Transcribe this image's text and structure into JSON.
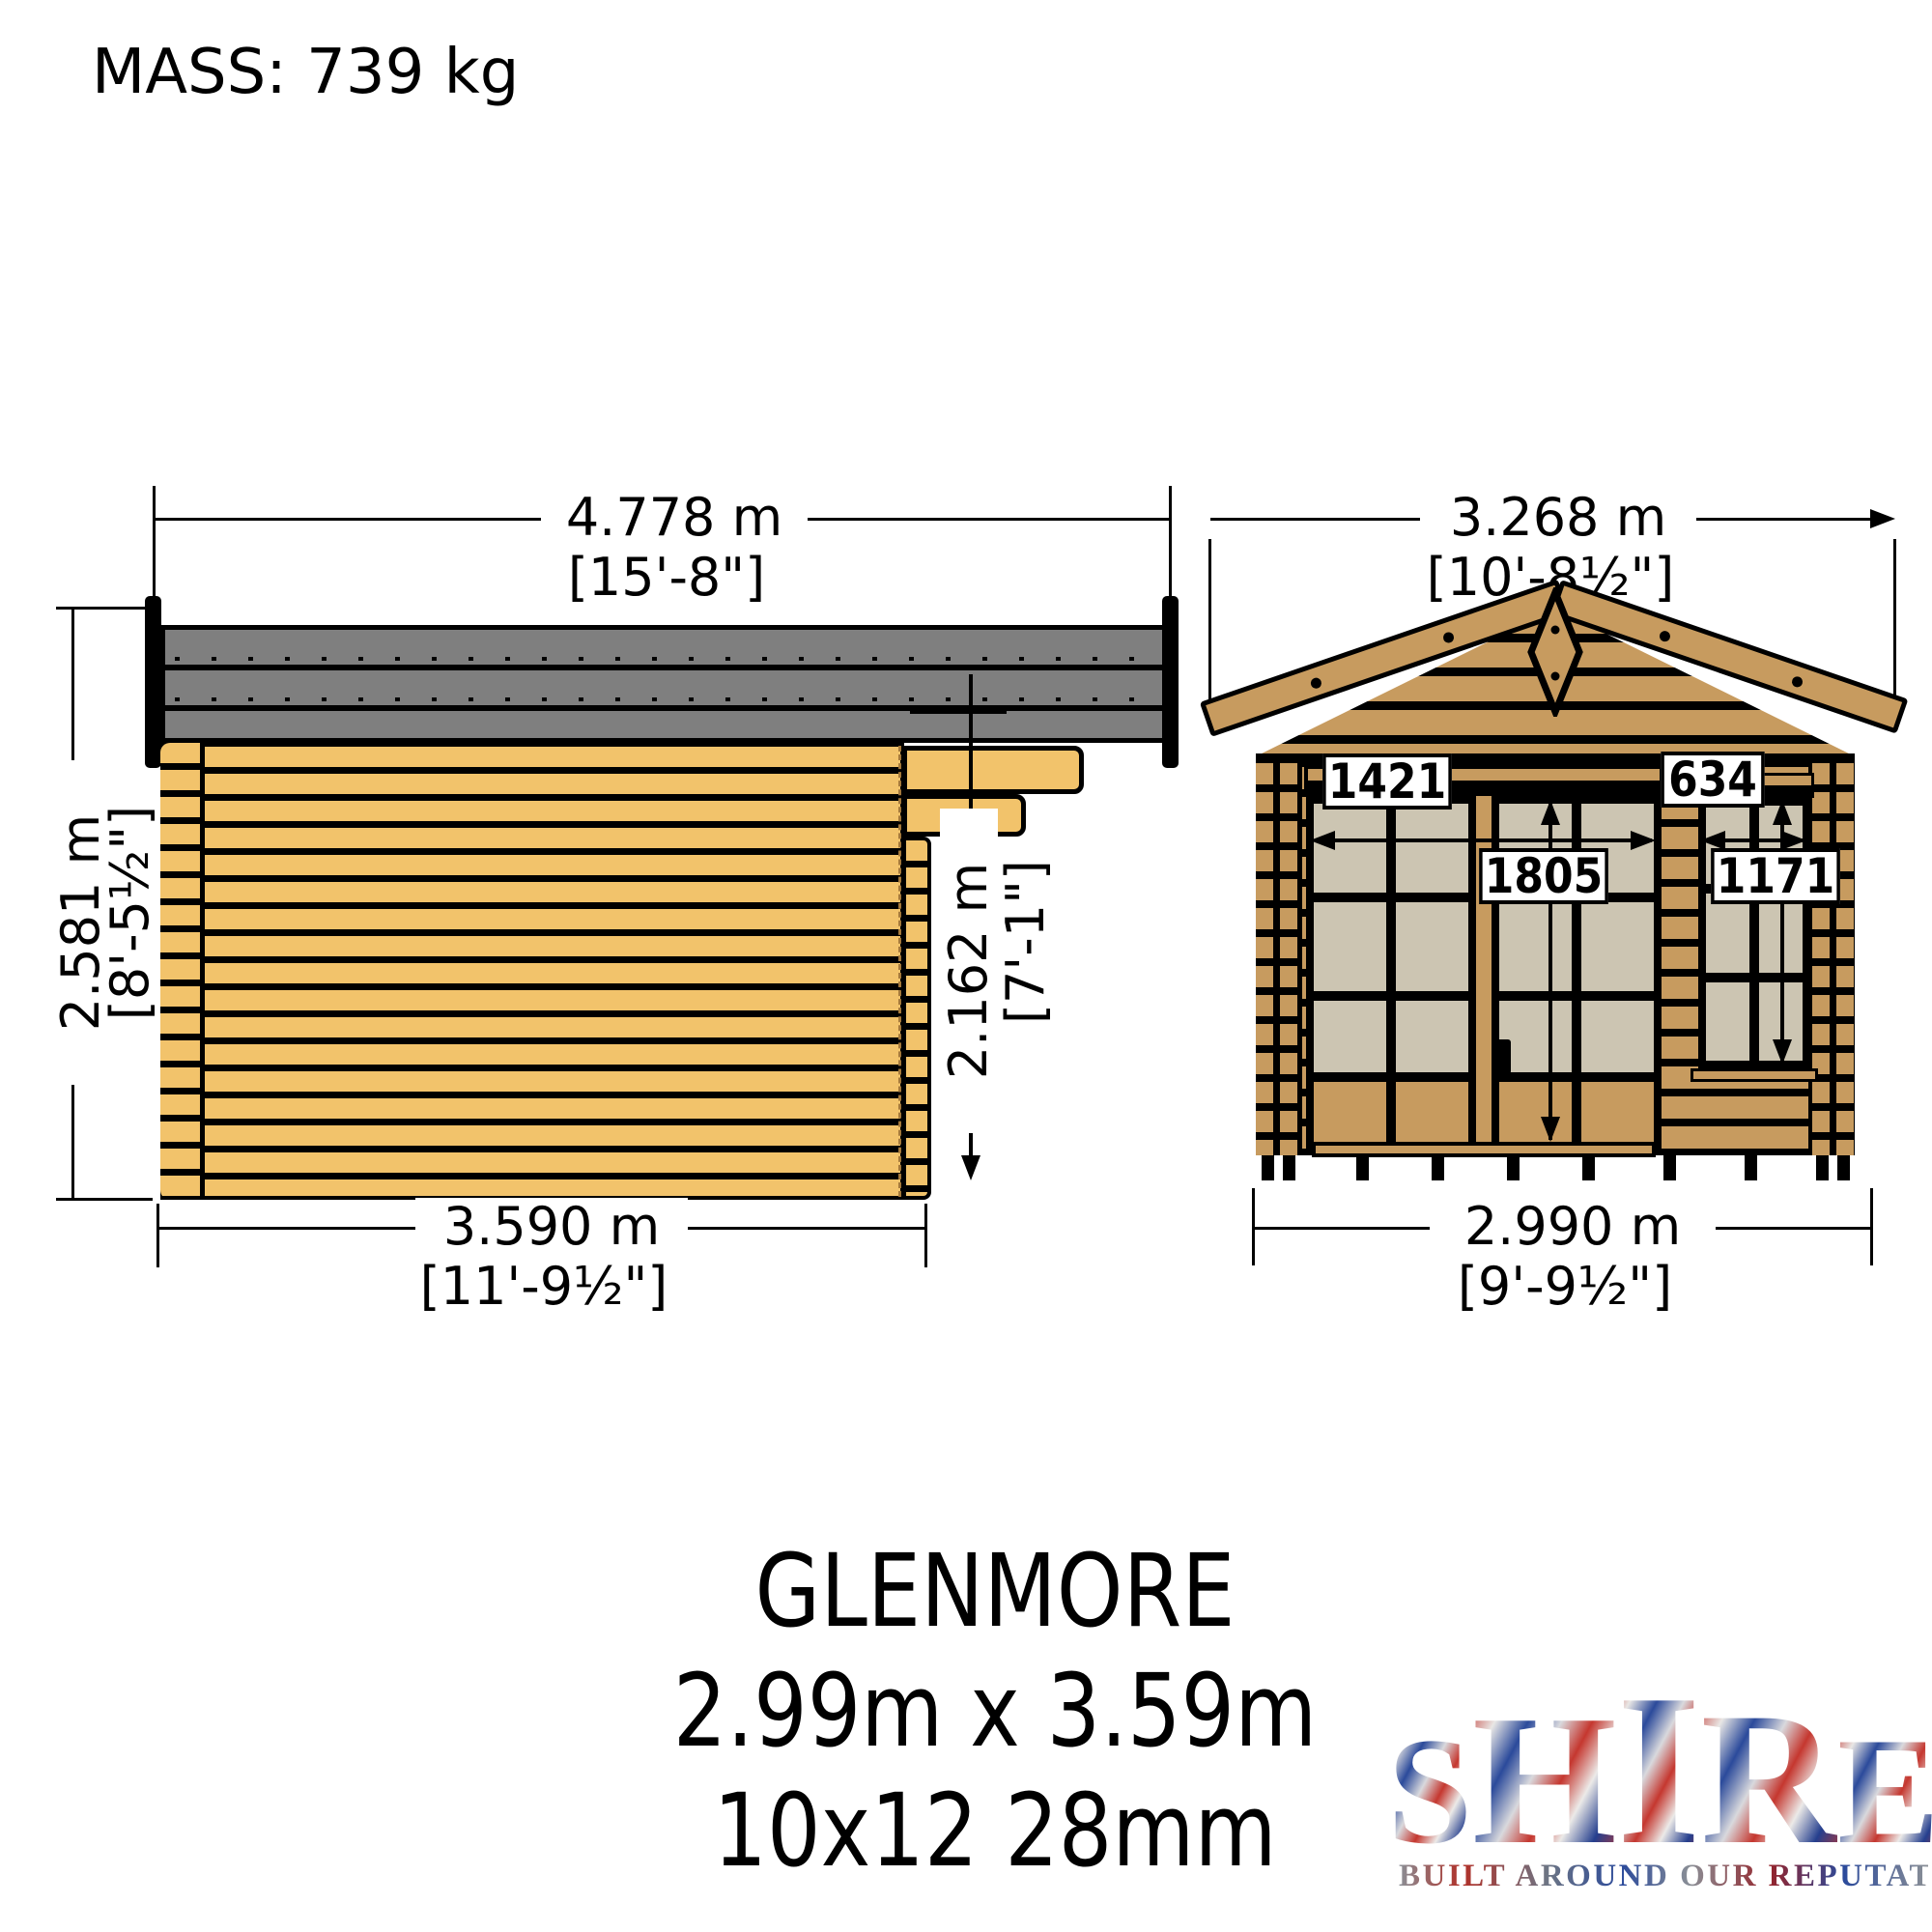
{
  "mass": "MASS: 739 kg",
  "side": {
    "width_m": "4.778 m",
    "width_ft": "[15'-8\"]",
    "height_m": "2.581 m",
    "height_ft": "[8'-5½\"]",
    "canopy_height_m": "2.162 m",
    "canopy_height_ft": "[7'-1\"]",
    "depth_m": "3.590 m",
    "depth_ft": "[11'-9½\"]"
  },
  "front": {
    "width_m": "3.268 m",
    "width_ft": "[10'-8½\"]",
    "base_m": "2.990 m",
    "base_ft": "[9'-9½\"]",
    "door_width_mm": "1421",
    "door_height_mm": "1805",
    "window_width_mm": "634",
    "window_height_mm": "1171"
  },
  "footer": {
    "product_name": "GLENMORE",
    "size_metric": "2.99m x 3.59m",
    "size_spec": "10x12 28mm"
  },
  "logo": {
    "letters": [
      "S",
      "H",
      "I",
      "R",
      "E"
    ],
    "tagline": "BUILT AROUND OUR REPUTATION"
  },
  "colors": {
    "wood_light": "#F2C36B",
    "wood_dark": "#C79B5F",
    "glass": "#CCC5B2",
    "roof_gray": "#7F7F7F",
    "line": "#000000"
  }
}
